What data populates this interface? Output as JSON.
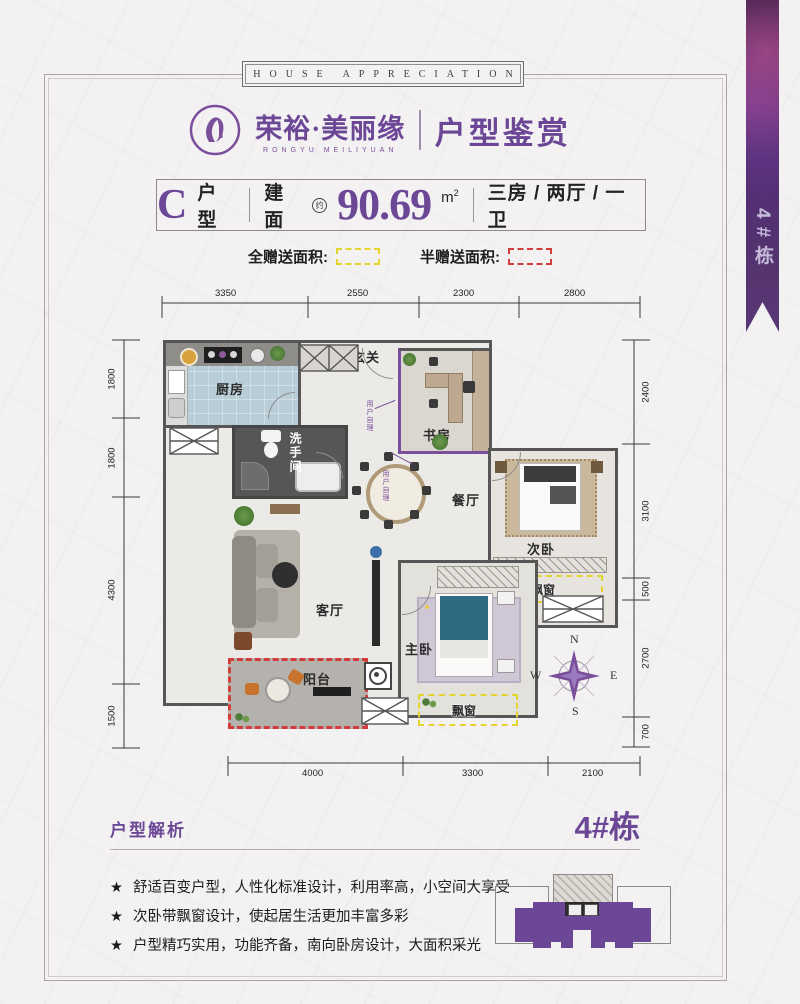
{
  "ribbon": {
    "label": "4#栋"
  },
  "banner": {
    "text": "HOUSE APPRECIATION"
  },
  "header": {
    "brand_cn": "荣裕·美丽缘",
    "brand_en": "RONGYU MEILIYUAN",
    "title": "户型鉴赏"
  },
  "info": {
    "unit_letter": "C",
    "unit_label": "户型",
    "area_label": "建面",
    "area_circle": "约",
    "area_value": "90.69",
    "area_unit": "m",
    "area_sup": "2",
    "rooms": "三房 / 两厅 / 一卫"
  },
  "legend": {
    "full_label": "全赠送面积:",
    "half_label": "半赠送面积:"
  },
  "plan": {
    "rooms": {
      "kitchen": "厨房",
      "entry": "玄关",
      "study": "书房",
      "bathroom": "洗手间",
      "dining": "餐厅",
      "bedroom2": "次卧",
      "living": "客厅",
      "master": "主卧",
      "balcony": "阳台",
      "bay1": "飘窗",
      "bay2": "飘窗"
    },
    "note": "用户自理",
    "compass": {
      "n": "N",
      "e": "E",
      "s": "S",
      "w": "W"
    },
    "dims": {
      "top": [
        "3350",
        "2550",
        "2300",
        "2800"
      ],
      "left": [
        "1800",
        "1800",
        "4300",
        "1500"
      ],
      "right": [
        "2400",
        "3100",
        "500",
        "2700",
        "700"
      ],
      "bottom": [
        "4000",
        "3300",
        "2100"
      ]
    }
  },
  "analysis": {
    "title": "户型解析",
    "building": "4#栋",
    "star": "★",
    "bullets": [
      "舒适百变户型，人性化标准设计，利用率高，小空间大享受",
      "次卧带飘窗设计，使起居生活更加丰富多彩",
      "户型精巧实用，功能齐备，南向卧房设计，大面积采光"
    ]
  },
  "colors": {
    "brand": "#6b4796",
    "full_gift": "#e3d42f",
    "half_gift": "#d43c3c",
    "wall": "#5a5a5a"
  }
}
